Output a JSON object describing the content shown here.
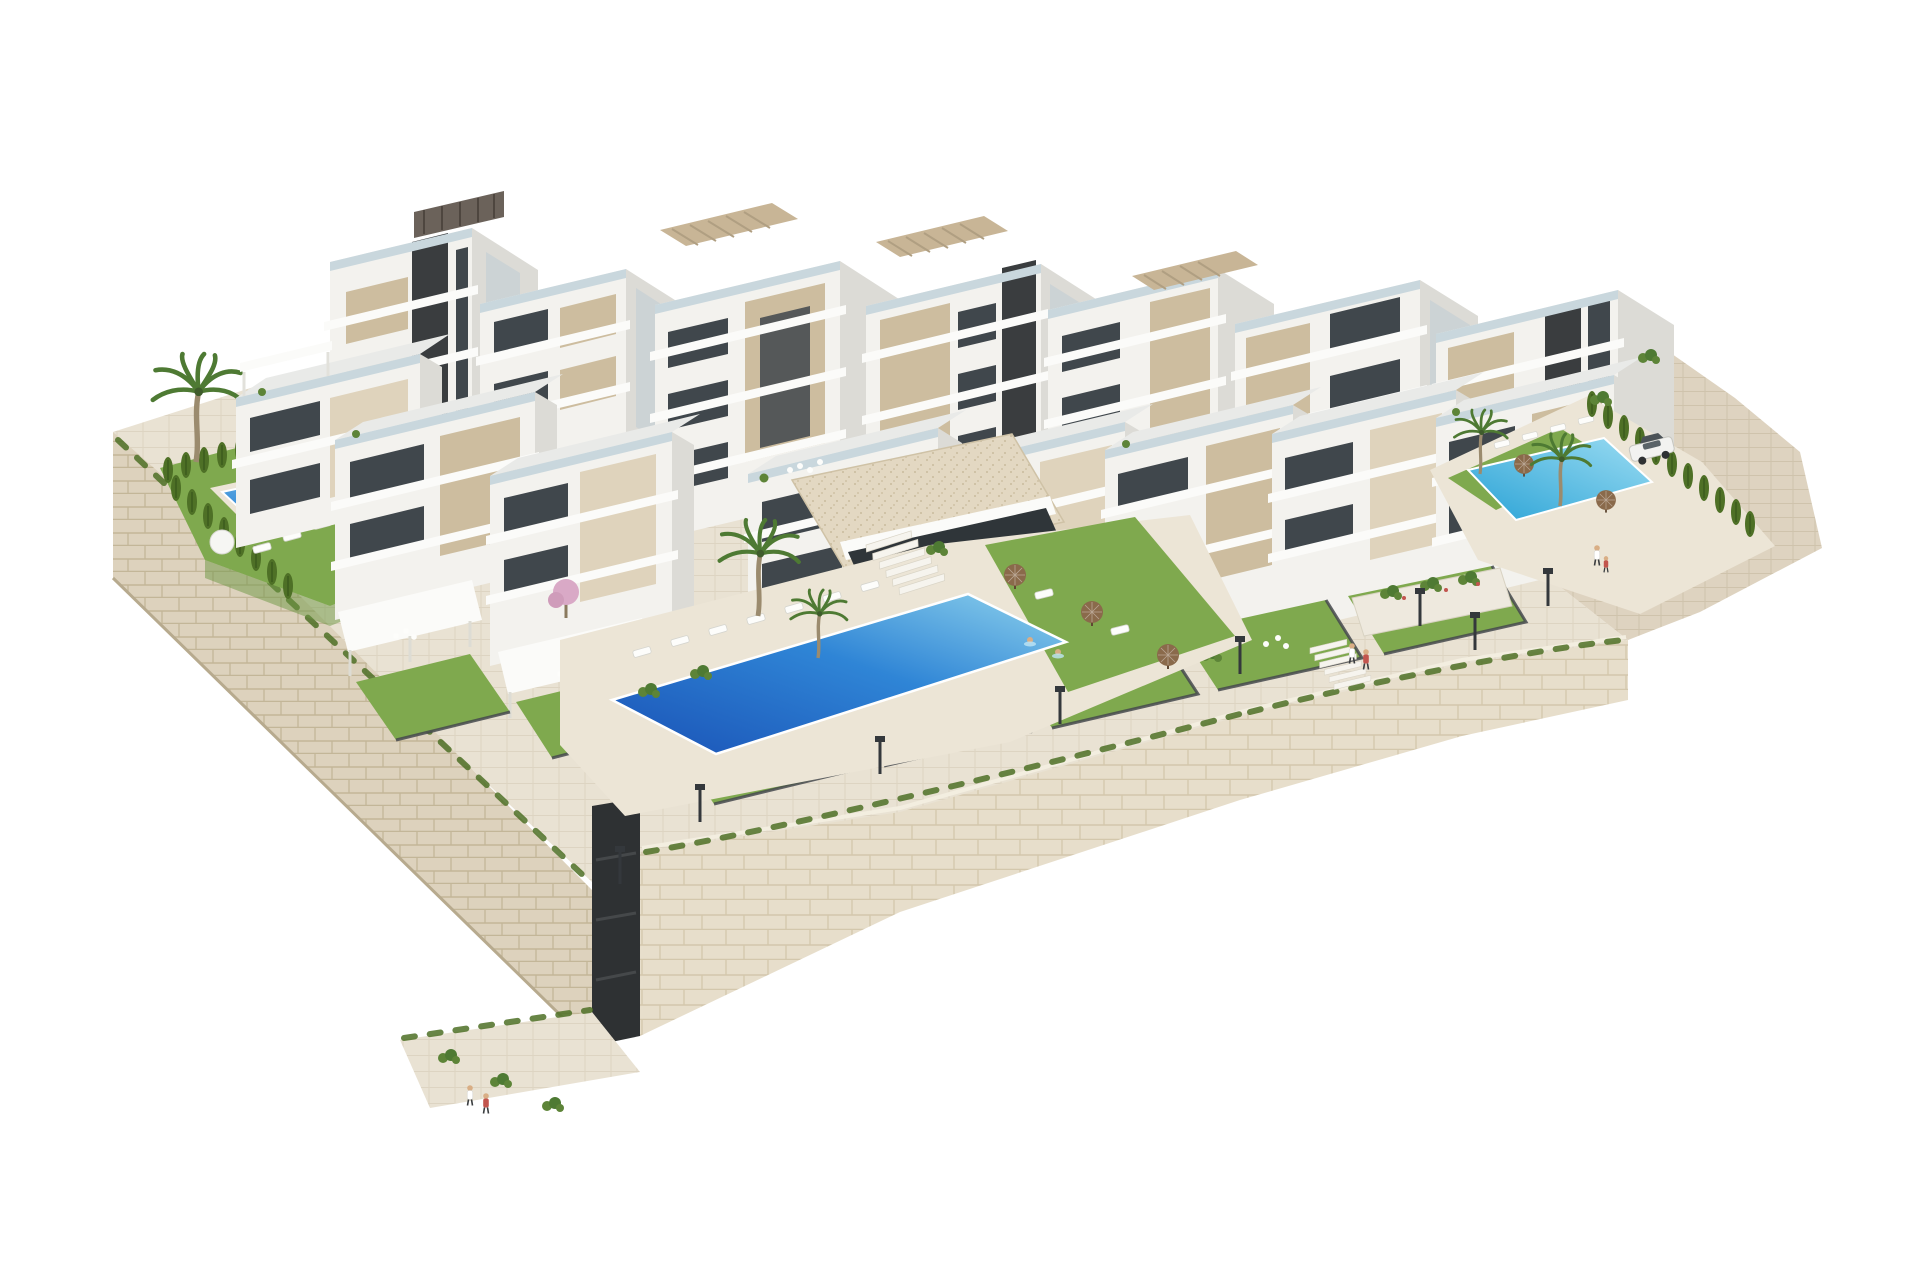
{
  "scene": {
    "type": "3d-architectural-render",
    "subject": "hillside residential complex of terraced white apartment buildings with private gardens, three swimming pools, stone retaining walls and landscaping on a white background",
    "background": "#ffffff",
    "palette": {
      "bldg_front": "#f3f2ee",
      "bldg_side": "#dcdbd6",
      "bldg_roof": "#e9eae8",
      "slab": "#fbfbf9",
      "accent": "#cdbd9f",
      "accent2": "#dfd3bc",
      "glazing": "#40474c",
      "glazing_side": "#ccd3d5",
      "railing": "#c9d7dd",
      "core": "#3a3d3f",
      "grass": "#7fa94e",
      "grass_dark": "#6c9642",
      "hedge": "#45621f",
      "cypress": "#4e7026",
      "frond": "#4e7a33",
      "trunk": "#9b8b6e",
      "stone": "#ddd2bd",
      "stone_line": "#c3b698",
      "stone2": "#e7decb",
      "stone2_line": "#d3c7ac",
      "pave": "#e9e2d3",
      "pave_line": "#d8cebb",
      "slope": "#ded3c0",
      "slope_line": "#ccc0a7",
      "deck": "#ece5d6",
      "fence": "#45494d",
      "pool_deep": "#1a52b6",
      "pool_mid": "#2f85d6",
      "pool_light": "#8ed2ec",
      "poolr_a": "#2ba3d6",
      "poolr_b": "#9bdcf2",
      "umbrella_tan": "#c9aa7e",
      "umbrella_brown": "#8a6a4b",
      "pink": "#d9a9c6",
      "shrub": "#5d8438",
      "pergola": "#c8b596",
      "pergola_dark": "#5f574e",
      "skin": "#d9ae85",
      "car_body": "#f2f2f0"
    },
    "objects": [
      {
        "name": "apartment-building",
        "count": 15
      },
      {
        "name": "swimming-pool",
        "count": 3
      },
      {
        "name": "private-garden-lawn",
        "count": 10
      },
      {
        "name": "palm-tree",
        "count": 7
      },
      {
        "name": "cypress-hedge-row",
        "count": 3
      },
      {
        "name": "street-lamp",
        "count": 8
      },
      {
        "name": "person",
        "count": 6
      },
      {
        "name": "car",
        "count": 1
      },
      {
        "name": "stone-retaining-wall",
        "count": 2
      },
      {
        "name": "garage-entrance",
        "count": 1
      },
      {
        "name": "sun-lounger",
        "count": 16
      },
      {
        "name": "parasol",
        "count": 8
      },
      {
        "name": "roof-pergola",
        "count": 4
      }
    ]
  }
}
